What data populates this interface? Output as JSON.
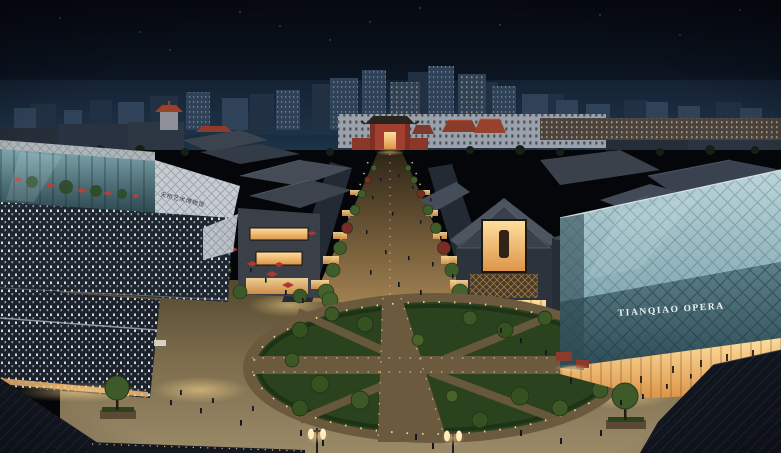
{
  "scene": {
    "title": "Tianqiao district — aerial night rendering",
    "description": "Aerial architectural night rendering of a commercial plaza: a glass museum block with a perforated dark facade on the left and the glass Tianqiao Opera hall on the right flank a tree-lined pedestrian street leading to a red traditional gate, with an oval lawn plaza, strolling crowds, red market umbrellas, street lamps and a lit city skyline on the horizon.",
    "elements": [
      "night sky with faint stars",
      "lit city skyline",
      "traditional red-roof halls",
      "glass museum building with dotted facade",
      "pedestrian shopping street",
      "red traditional gate (paifang)",
      "gabled stone retail buildings",
      "oval lawn plaza with cross walkways",
      "Tianqiao Opera glass hall",
      "red market umbrellas and stalls",
      "twin-head street lamps",
      "crowds of pedestrians",
      "foreground slate roofs"
    ]
  },
  "signs": {
    "opera": "TIANQIAO OPERA",
    "museum": "天桥艺术博物馆"
  },
  "palette": {
    "sky_top": "#06090f",
    "sky_horizon": "#1d3349",
    "skyline_tower": "#2f4257",
    "skyline_back": "#223143",
    "window_cool": "#aecde2",
    "window_warm": "#e8c088",
    "glass_teal_light": "#b8d4d8",
    "glass_teal_dark": "#34545e",
    "museum_facade": "#1e2630",
    "facade_dot": "#e9edf3",
    "lattice_white": "#c6ccd2",
    "roof_gray": "#46505c",
    "roof_foreground": "#12161e",
    "paving_light": "#9a8a68",
    "paving_dark": "#5f513b",
    "lawn_green": "#2b421f",
    "tree_green": "#3c5826",
    "tree_red": "#7c2b24",
    "accent_red": "#a2402f",
    "lamp_glow": "#ffd9a0",
    "storefront_warm": "#f0b468"
  }
}
